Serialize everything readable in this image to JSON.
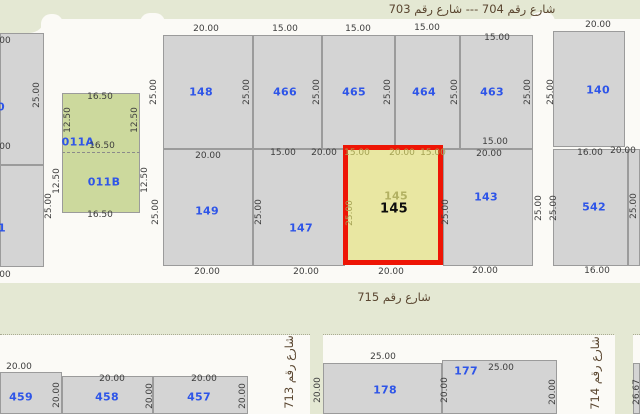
{
  "map": {
    "type": "cadastral-parcel-map",
    "selected_parcel": "145",
    "colors": {
      "street-white": "#fbfaf6",
      "area-green": "#e4e8d3",
      "parcel-fill": "#d4d4d4",
      "parcel-border": "#9b9b9b",
      "lot-green": "#ccd99d",
      "selected-fill": "#e9e7a2",
      "selected-border": "#ee1505",
      "number-blue": "#2e55e8",
      "dim-gray": "#3d3d3d",
      "dim-olive": "#a5a355",
      "street-text": "#5a4630"
    },
    "green_areas": [
      {
        "x": 0,
        "y": 0,
        "w": 640,
        "h": 19
      },
      {
        "x": 0,
        "y": 0,
        "w": 45,
        "h": 33,
        "br": "0 0 16px 0"
      },
      {
        "x": 0,
        "y": 283,
        "w": 640,
        "h": 51,
        "dotted": 1
      },
      {
        "x": 310,
        "y": 334,
        "w": 13,
        "h": 80
      },
      {
        "x": 615,
        "y": 334,
        "w": 18,
        "h": 80
      }
    ],
    "street_notches": [
      {
        "x": 41,
        "y": 14,
        "w": 22,
        "h": 20
      },
      {
        "x": 140,
        "y": 13,
        "w": 25,
        "h": 22
      },
      {
        "x": 530,
        "y": 12,
        "w": 25,
        "h": 23
      }
    ],
    "parcels": [
      {
        "id": "edge-left-upper",
        "x": 0,
        "y": 33,
        "w": 44,
        "h": 132
      },
      {
        "id": "edge-left-lower",
        "x": 0,
        "y": 165,
        "w": 44,
        "h": 102
      },
      {
        "id": "011B",
        "x": 62,
        "y": 152,
        "w": 78,
        "h": 61,
        "cls": "green-lot"
      },
      {
        "id": "011A",
        "x": 62,
        "y": 93,
        "w": 78,
        "h": 60,
        "cls": "green-lot dash-bottom"
      },
      {
        "id": "148",
        "x": 163,
        "y": 35,
        "w": 90,
        "h": 114
      },
      {
        "id": "466",
        "x": 253,
        "y": 35,
        "w": 69,
        "h": 114
      },
      {
        "id": "465",
        "x": 322,
        "y": 35,
        "w": 73,
        "h": 114
      },
      {
        "id": "464",
        "x": 395,
        "y": 35,
        "w": 65,
        "h": 114
      },
      {
        "id": "463",
        "x": 460,
        "y": 35,
        "w": 73,
        "h": 114
      },
      {
        "id": "140",
        "x": 553,
        "y": 31,
        "w": 72,
        "h": 116
      },
      {
        "id": "149",
        "x": 163,
        "y": 149,
        "w": 90,
        "h": 117
      },
      {
        "id": "147",
        "x": 253,
        "y": 149,
        "w": 92,
        "h": 117
      },
      {
        "id": "143",
        "x": 443,
        "y": 149,
        "w": 90,
        "h": 117
      },
      {
        "id": "542",
        "x": 553,
        "y": 149,
        "w": 75,
        "h": 117
      },
      {
        "id": "edge-right-mid",
        "x": 628,
        "y": 149,
        "w": 12,
        "h": 117
      },
      {
        "id": "459",
        "x": 0,
        "y": 372,
        "w": 62,
        "h": 42
      },
      {
        "id": "458",
        "x": 62,
        "y": 376,
        "w": 91,
        "h": 38
      },
      {
        "id": "457",
        "x": 153,
        "y": 376,
        "w": 95,
        "h": 38
      },
      {
        "id": "178",
        "x": 323,
        "y": 363,
        "w": 119,
        "h": 51
      },
      {
        "id": "177",
        "x": 442,
        "y": 360,
        "w": 115,
        "h": 54
      },
      {
        "id": "edge-bottom-right",
        "x": 633,
        "y": 363,
        "w": 7,
        "h": 51
      },
      {
        "id": "145",
        "x": 343,
        "y": 145,
        "w": 100,
        "h": 120,
        "cls": "highlight"
      }
    ],
    "parcel_numbers": [
      {
        "t": "148",
        "x": 201,
        "y": 92
      },
      {
        "t": "466",
        "x": 285,
        "y": 92
      },
      {
        "t": "465",
        "x": 354,
        "y": 92
      },
      {
        "t": "464",
        "x": 424,
        "y": 92
      },
      {
        "t": "463",
        "x": 492,
        "y": 92
      },
      {
        "t": "140",
        "x": 598,
        "y": 90
      },
      {
        "t": "149",
        "x": 207,
        "y": 211
      },
      {
        "t": "147",
        "x": 301,
        "y": 228
      },
      {
        "t": "143",
        "x": 486,
        "y": 197
      },
      {
        "t": "542",
        "x": 594,
        "y": 207
      },
      {
        "t": "011A",
        "x": 78,
        "y": 142
      },
      {
        "t": "011B",
        "x": 104,
        "y": 182
      },
      {
        "t": "0",
        "x": 1,
        "y": 107
      },
      {
        "t": "1",
        "x": 2,
        "y": 228
      },
      {
        "t": "459",
        "x": 21,
        "y": 397
      },
      {
        "t": "458",
        "x": 107,
        "y": 397
      },
      {
        "t": "457",
        "x": 199,
        "y": 397
      },
      {
        "t": "178",
        "x": 385,
        "y": 390
      },
      {
        "t": "177",
        "x": 466,
        "y": 371
      },
      {
        "t": "145",
        "x": 396,
        "y": 196,
        "cls": "faded"
      },
      {
        "t": "145",
        "x": 394,
        "y": 209,
        "cls": "selected"
      }
    ],
    "dimensions": [
      {
        "t": "20.00",
        "x": 206,
        "y": 29
      },
      {
        "t": "15.00",
        "x": 285,
        "y": 29
      },
      {
        "t": "15.00",
        "x": 358,
        "y": 29
      },
      {
        "t": "15.00",
        "x": 427,
        "y": 28
      },
      {
        "t": "15.00",
        "x": 497,
        "y": 38
      },
      {
        "t": "20.00",
        "x": 598,
        "y": 25
      },
      {
        "t": "00",
        "x": 5,
        "y": 41
      },
      {
        "t": "00",
        "x": 5,
        "y": 147
      },
      {
        "t": "00",
        "x": 5,
        "y": 275
      },
      {
        "t": "16.50",
        "x": 100,
        "y": 97
      },
      {
        "t": "16.50",
        "x": 102,
        "y": 146
      },
      {
        "t": "16.50",
        "x": 100,
        "y": 215
      },
      {
        "t": "12.50",
        "x": 68,
        "y": 120,
        "r": 1
      },
      {
        "t": "12.50",
        "x": 135,
        "y": 120,
        "r": 1
      },
      {
        "t": "12.50",
        "x": 57,
        "y": 181,
        "r": 1
      },
      {
        "t": "12.50",
        "x": 145,
        "y": 180,
        "r": 1
      },
      {
        "t": "25.00",
        "x": 37,
        "y": 95,
        "r": 1
      },
      {
        "t": "25.00",
        "x": 154,
        "y": 92,
        "r": 1
      },
      {
        "t": "25.00",
        "x": 247,
        "y": 92,
        "r": 1
      },
      {
        "t": "25.00",
        "x": 317,
        "y": 92,
        "r": 1
      },
      {
        "t": "25.00",
        "x": 388,
        "y": 92,
        "r": 1
      },
      {
        "t": "25.00",
        "x": 455,
        "y": 92,
        "r": 1
      },
      {
        "t": "25.00",
        "x": 528,
        "y": 92,
        "r": 1
      },
      {
        "t": "25.00",
        "x": 551,
        "y": 92,
        "r": 1
      },
      {
        "t": "20.00",
        "x": 208,
        "y": 156
      },
      {
        "t": "15.00",
        "x": 283,
        "y": 153
      },
      {
        "t": "20.00",
        "x": 324,
        "y": 153
      },
      {
        "t": "15.00",
        "x": 357,
        "y": 153,
        "c": "olive"
      },
      {
        "t": "20.00",
        "x": 402,
        "y": 153,
        "c": "olive"
      },
      {
        "t": "15.00",
        "x": 433,
        "y": 153,
        "c": "olive"
      },
      {
        "t": "15.00",
        "x": 495,
        "y": 142
      },
      {
        "t": "20.00",
        "x": 489,
        "y": 154
      },
      {
        "t": "16.00",
        "x": 590,
        "y": 153
      },
      {
        "t": "20.00",
        "x": 623,
        "y": 151
      },
      {
        "t": "25.00",
        "x": 49,
        "y": 206,
        "r": 1
      },
      {
        "t": "25.00",
        "x": 156,
        "y": 212,
        "r": 1
      },
      {
        "t": "25.00",
        "x": 259,
        "y": 212,
        "r": 1
      },
      {
        "t": "25.00",
        "x": 350,
        "y": 213,
        "r": 1,
        "c": "olive"
      },
      {
        "t": "25.00",
        "x": 446,
        "y": 212,
        "r": 1
      },
      {
        "t": "25.00",
        "x": 539,
        "y": 208,
        "r": 1
      },
      {
        "t": "25.00",
        "x": 554,
        "y": 208,
        "r": 1
      },
      {
        "t": "25.00",
        "x": 634,
        "y": 206,
        "r": 1
      },
      {
        "t": "20.00",
        "x": 207,
        "y": 272
      },
      {
        "t": "20.00",
        "x": 306,
        "y": 272
      },
      {
        "t": "20.00",
        "x": 391,
        "y": 272
      },
      {
        "t": "20.00",
        "x": 485,
        "y": 271
      },
      {
        "t": "16.00",
        "x": 597,
        "y": 271
      },
      {
        "t": "20.00",
        "x": 19,
        "y": 367
      },
      {
        "t": "20.00",
        "x": 112,
        "y": 379
      },
      {
        "t": "20.00",
        "x": 204,
        "y": 379
      },
      {
        "t": "20.00",
        "x": 57,
        "y": 395,
        "r": 1
      },
      {
        "t": "20.00",
        "x": 150,
        "y": 396,
        "r": 1
      },
      {
        "t": "20.00",
        "x": 243,
        "y": 396,
        "r": 1
      },
      {
        "t": "25.00",
        "x": 383,
        "y": 357
      },
      {
        "t": "25.00",
        "x": 501,
        "y": 368
      },
      {
        "t": "20.00",
        "x": 318,
        "y": 390,
        "r": 1
      },
      {
        "t": "20.00",
        "x": 445,
        "y": 390,
        "r": 1
      },
      {
        "t": "20.00",
        "x": 553,
        "y": 392,
        "r": 1
      },
      {
        "t": "26.67",
        "x": 637,
        "y": 392,
        "r": 1
      }
    ],
    "street_labels": [
      {
        "t": "شارع رقم 704 --- شارع رقم 703",
        "x": 472,
        "y": 9,
        "name": "street-704-703"
      },
      {
        "t": "شارع رقم 715",
        "x": 394,
        "y": 297,
        "name": "street-715"
      },
      {
        "t": "شارع رقم 713",
        "x": 289,
        "y": 372,
        "v": 1,
        "name": "street-713"
      },
      {
        "t": "شارع رقم 714",
        "x": 595,
        "y": 373,
        "v": 1,
        "name": "street-714"
      }
    ]
  }
}
